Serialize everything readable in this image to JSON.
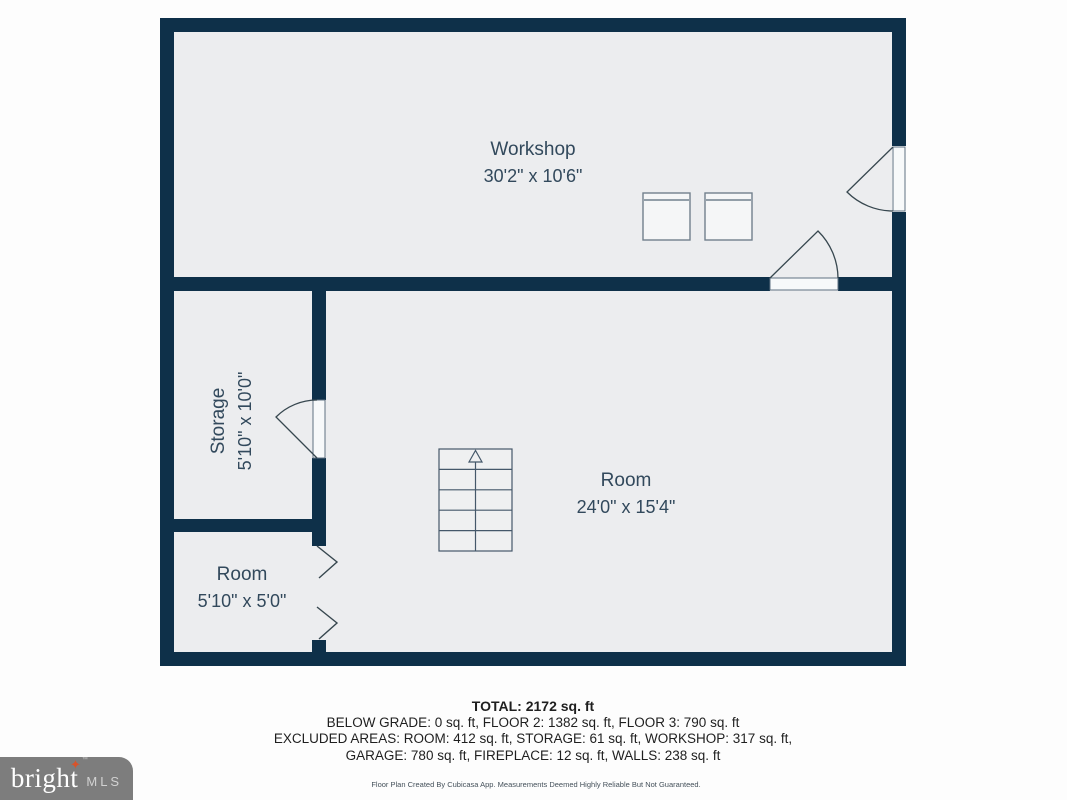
{
  "plan": {
    "rooms": [
      {
        "id": "workshop",
        "name": "Workshop",
        "dimensions": "30'2\" x 10'6\""
      },
      {
        "id": "storage",
        "name": "Storage",
        "dimensions": "5'10\" x 10'0\""
      },
      {
        "id": "room-small",
        "name": "Room",
        "dimensions": "5'10\" x 5'0\""
      },
      {
        "id": "room-main",
        "name": "Room",
        "dimensions": "24'0\" x 15'4\""
      }
    ],
    "fixtures": [
      "staircase-up",
      "appliance-left",
      "appliance-right"
    ],
    "doors": [
      "workshop-right-door",
      "workshop-bottom-door",
      "storage-door",
      "closet-bifold-doors"
    ]
  },
  "summary": {
    "total": "TOTAL: 2172 sq. ft",
    "line2": "BELOW GRADE: 0 sq. ft, FLOOR 2: 1382 sq. ft, FLOOR 3: 790 sq. ft",
    "line3": "EXCLUDED AREAS: ROOM: 412 sq. ft, STORAGE: 61 sq. ft, WORKSHOP: 317 sq. ft,",
    "line4": "GARAGE: 780 sq. ft, FIREPLACE: 12 sq. ft, WALLS: 238 sq. ft"
  },
  "disclaimer": "Floor Plan Created By Cubicasa App. Measurements Deemed Highly Reliable But Not Guaranteed.",
  "logo": {
    "brand": "bright",
    "star": "✦",
    "tm": "™",
    "suffix": "MLS"
  },
  "colors": {
    "wall": "#0e3049",
    "floor": "#ecedef",
    "label": "#32495c",
    "line": "#37474f",
    "logo_bg": "#7d7d7d",
    "logo_star": "#d9532a"
  }
}
